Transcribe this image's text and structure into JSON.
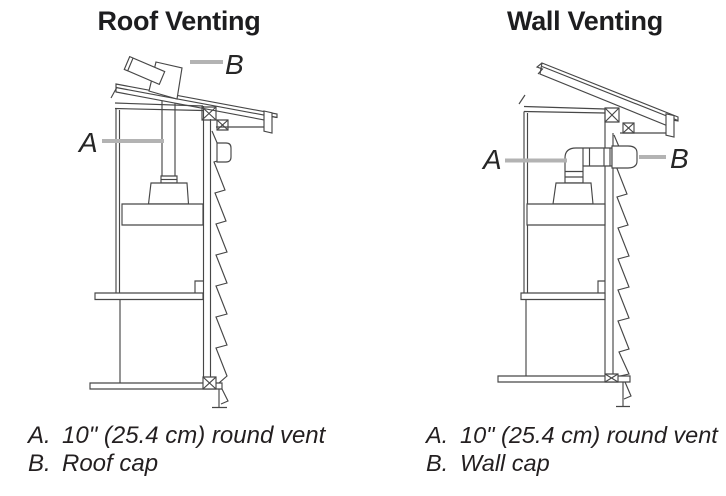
{
  "figures": [
    {
      "id": "roof-venting",
      "title": "Roof Venting",
      "label_a": "A",
      "label_b": "B",
      "legend": [
        {
          "marker": "A.",
          "text": "10\" (25.4 cm) round vent"
        },
        {
          "marker": "B.",
          "text": "Roof cap"
        }
      ]
    },
    {
      "id": "wall-venting",
      "title": "Wall Venting",
      "label_a": "A",
      "label_b": "B",
      "legend": [
        {
          "marker": "A.",
          "text": "10\" (25.4 cm) round vent"
        },
        {
          "marker": "B.",
          "text": "Wall cap"
        }
      ]
    }
  ],
  "colors": {
    "line": "#474747",
    "leader": "#b3b3b3",
    "text": "#231f20"
  }
}
